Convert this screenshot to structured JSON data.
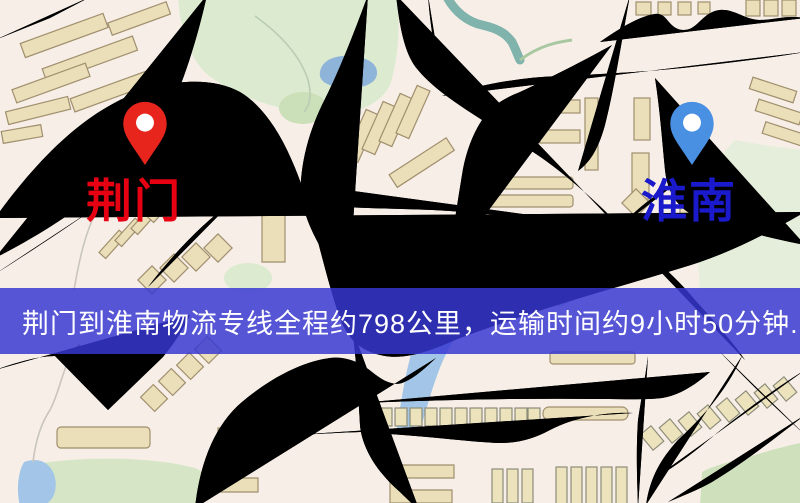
{
  "banner": {
    "text": "荆门到淮南物流专线全程约798公里，运输时间约9小时50分钟.",
    "background_color": "#3737d2",
    "text_color": "#ffffff"
  },
  "markers": [
    {
      "name": "origin",
      "label": "荆门",
      "pin_color": "#e8251c",
      "label_color": "#e60012"
    },
    {
      "name": "destination",
      "label": "淮南",
      "pin_color": "#4a90e2",
      "label_color": "#1a1acc"
    }
  ],
  "map_colors": {
    "base": "#f7efe7",
    "road_fill": "#f3ca6b",
    "road_border": "#e2ae50",
    "water": "#a3c6e8",
    "lake": "#8fb4da",
    "park": "#dcead0",
    "building": "#eadfb8",
    "railway": "#2e2e2e"
  }
}
